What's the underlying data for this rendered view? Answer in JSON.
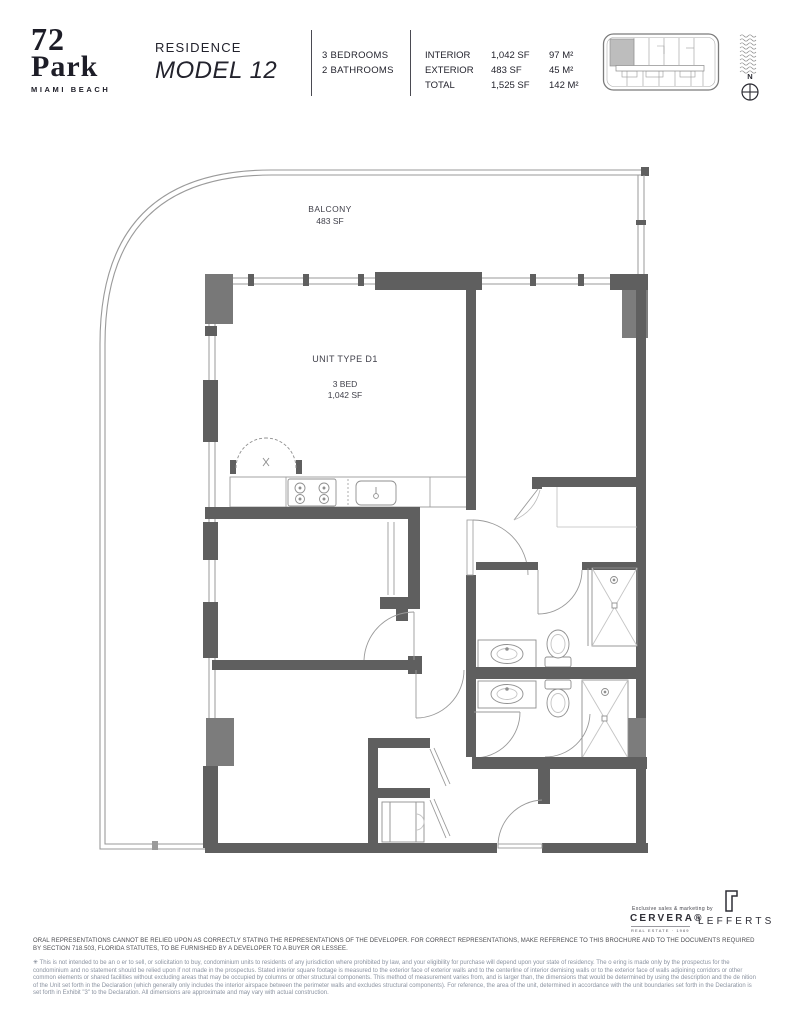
{
  "brand": {
    "number": "72",
    "name": "Park",
    "city": "MIAMI BEACH"
  },
  "header": {
    "residence_label": "RESIDENCE",
    "model_name": "MODEL 12",
    "bedrooms": "3 BEDROOMS",
    "bathrooms": "2 BATHROOMS",
    "areas": [
      {
        "label": "INTERIOR",
        "sf": "1,042 SF",
        "m2": "97 M²"
      },
      {
        "label": "EXTERIOR",
        "sf": "483 SF",
        "m2": "45 M²"
      },
      {
        "label": "TOTAL",
        "sf": "1,525 SF",
        "m2": "142 M²"
      }
    ],
    "compass_north": "N"
  },
  "plan": {
    "balcony_label": "BALCONY",
    "balcony_area": "483 SF",
    "unit_type": "UNIT TYPE D1",
    "unit_beds": "3 BED",
    "unit_area": "1,042 SF"
  },
  "footer": {
    "marketing_tagline": "Exclusive sales & marketing by",
    "cervera_name": "CERVERA®",
    "cervera_subtitle": "REAL ESTATE · 1969",
    "lefferts_name": "LEFFERTS",
    "disclaimer_primary": "ORAL REPRESENTATIONS CANNOT BE RELIED UPON AS CORRECTLY STATING THE REPRESENTATIONS OF THE DEVELOPER. FOR CORRECT REPRESENTATIONS, MAKE REFERENCE TO THIS BROCHURE AND TO THE DOCUMENTS REQUIRED BY SECTION 718.503, FLORIDA STATUTES, TO BE FURNISHED BY A DEVELOPER TO A BUYER OR LESSEE.",
    "disclaimer_marker": "✳",
    "disclaimer_secondary": "This is not intended to be an o er to sell, or solicitation to buy, condominium units to residents of any jurisdiction where prohibited by law, and your eligibility for purchase will depend upon your state of residency. The o ering is made only by the prospectus for the condominium and no statement should be relied upon if not made in the prospectus. Stated interior square footage is measured to the exterior face of exterior walls and to the centerline of interior demising walls or to the exterior face of walls adjoining corridors or other common elements or shared facilities without excluding areas that may be occupied by columns or other structural components. This method of measurement varies from, and is larger than, the dimensions that would be determined by using the description and the de nition of the Unit set forth in the Declaration (which generally only includes the interior airspace between the perimeter walls and excludes structural components). For reference, the area of the unit, determined in accordance with the unit boundaries set forth in the Declaration is set forth in Exhibit \"3\" to the Declaration. All dimensions are approximate and may vary with actual construction."
  }
}
